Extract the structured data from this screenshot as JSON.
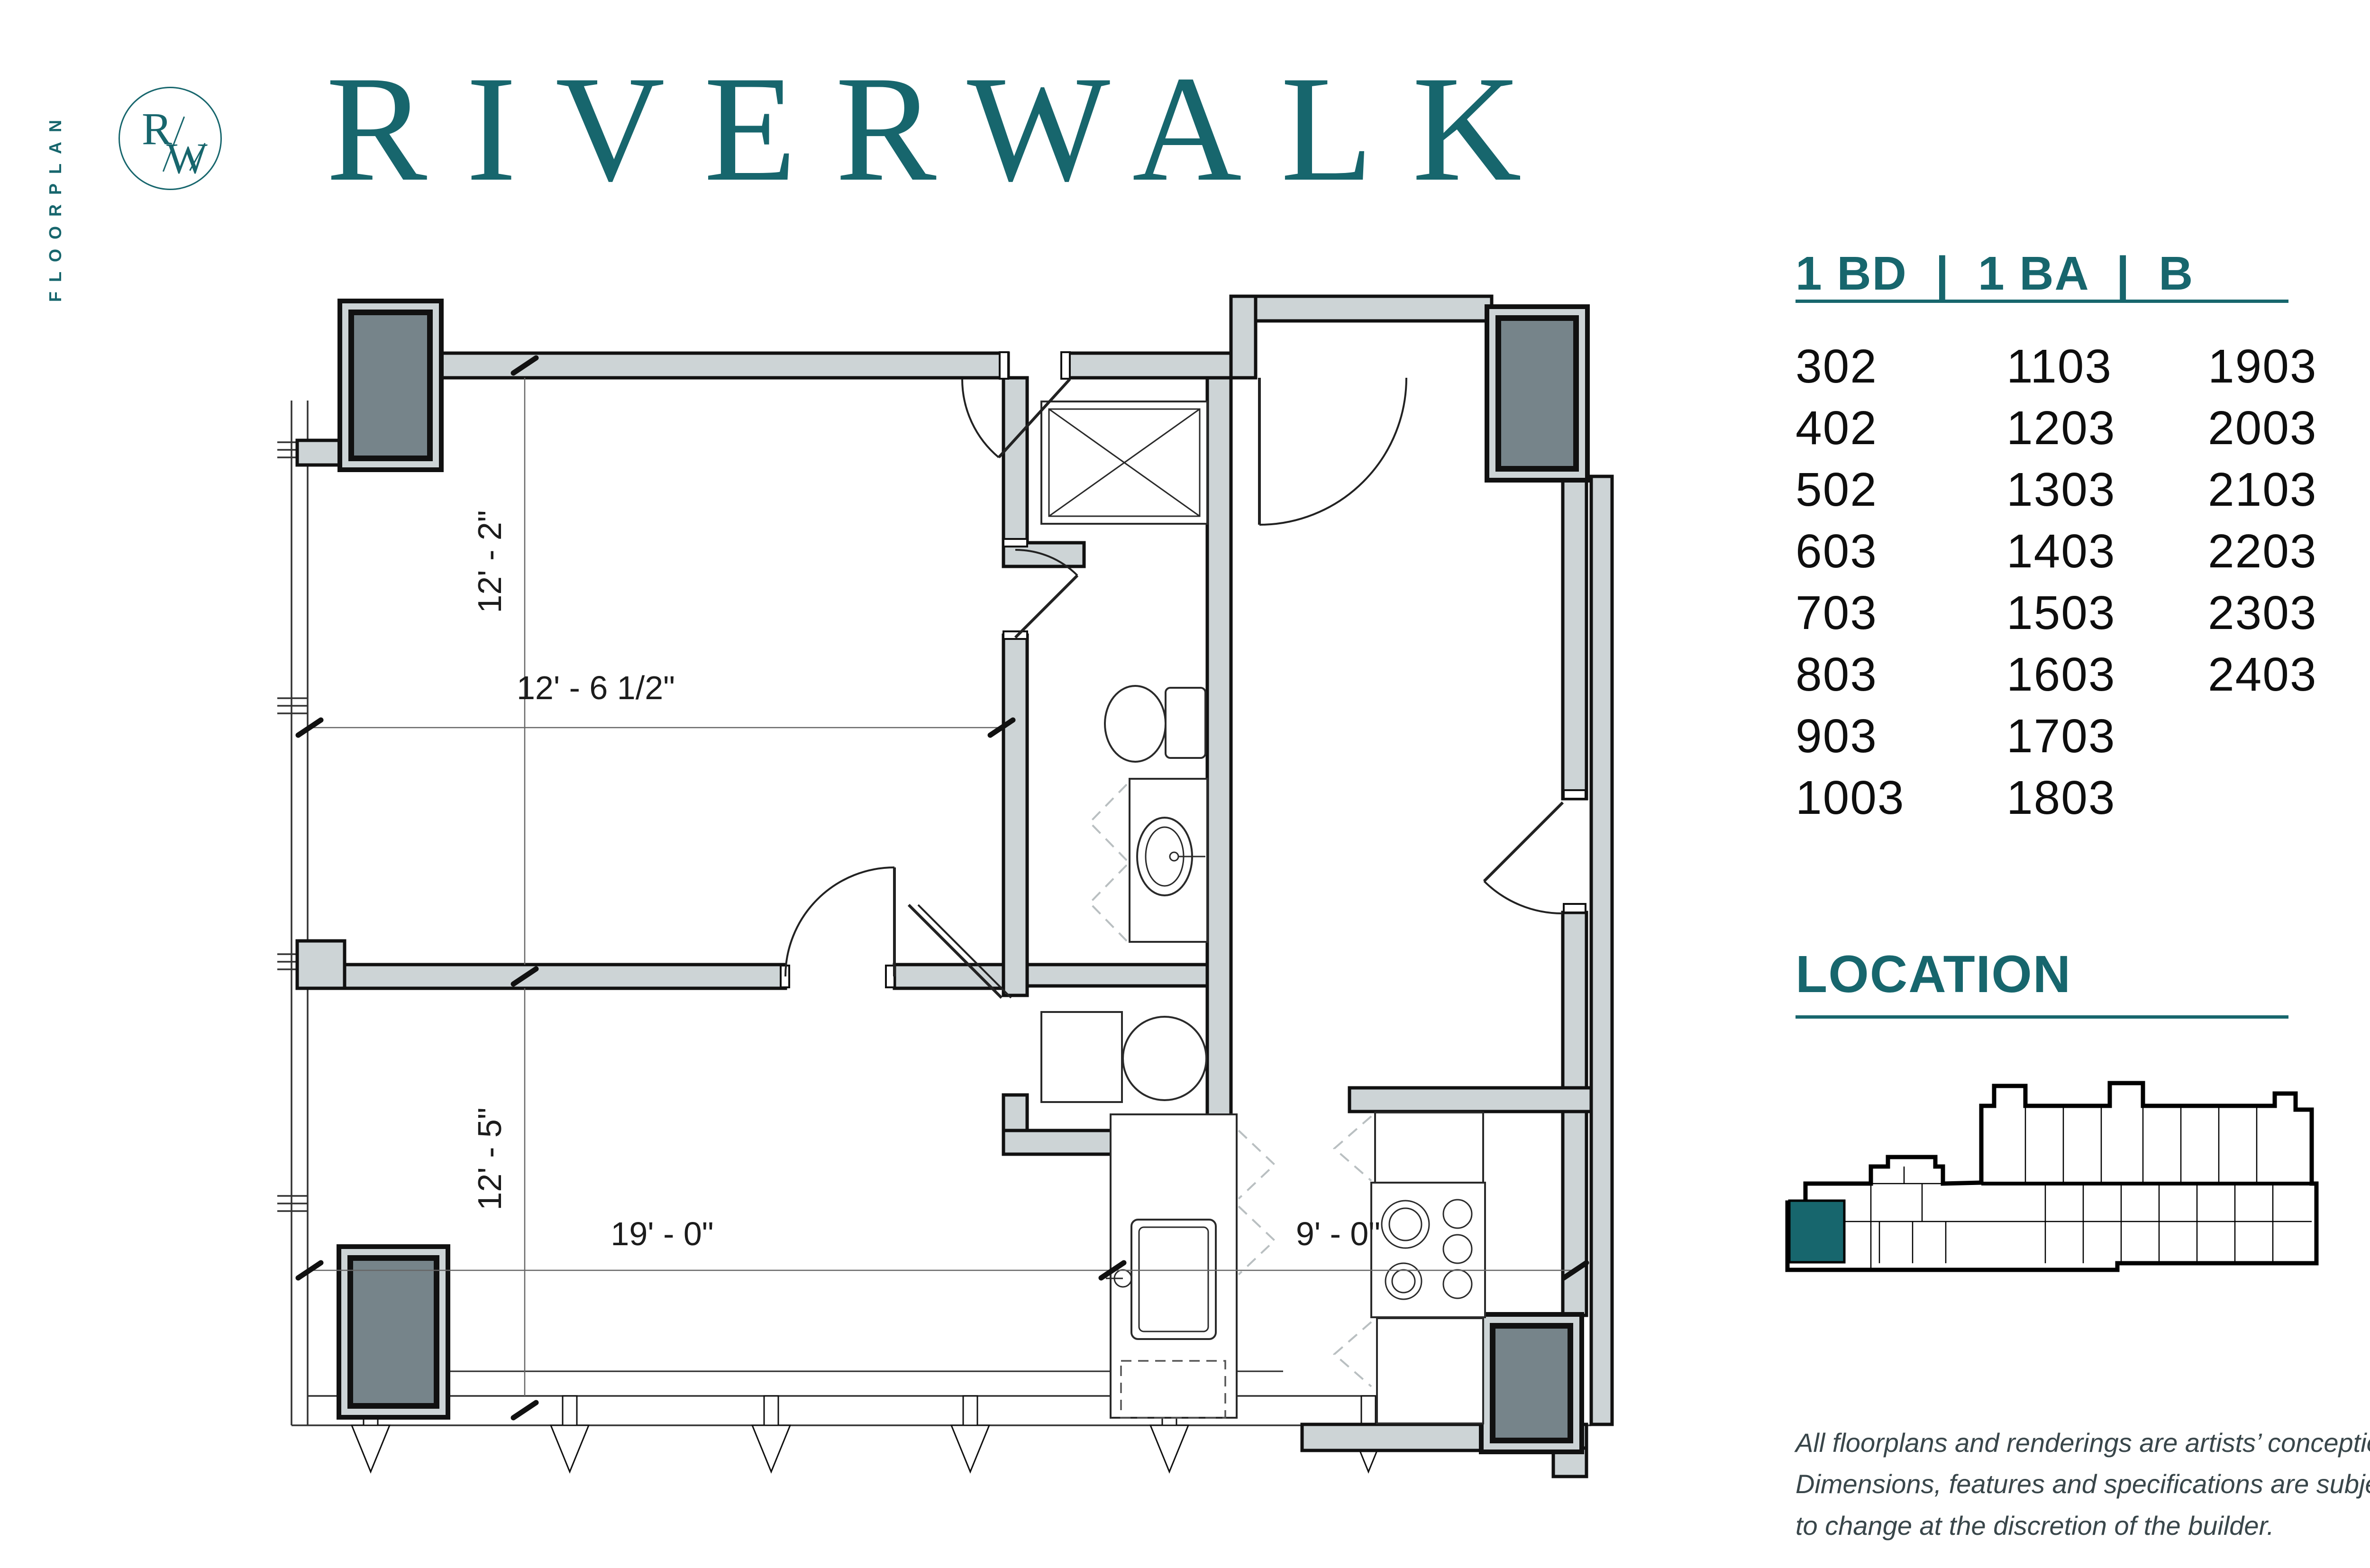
{
  "colors": {
    "teal": "#17666d",
    "wall_fill": "#cdd4d6",
    "shaft_fill": "#76848a",
    "disclaimer_text": "#39464a"
  },
  "sidebar": {
    "vertical_label": "FLOORPLAN"
  },
  "logo": {
    "letter_r": "R",
    "letter_w": "W"
  },
  "header": {
    "title": "RIVERWALK"
  },
  "unit_panel": {
    "header": "1 BD  |  1 BA  |  B",
    "columns": [
      [
        "302",
        "402",
        "502",
        "603",
        "703",
        "803",
        "903",
        "1003"
      ],
      [
        "1103",
        "1203",
        "1303",
        "1403",
        "1503",
        "1603",
        "1703",
        "1803"
      ],
      [
        "1903",
        "2003",
        "2103",
        "2203",
        "2303",
        "2403"
      ]
    ]
  },
  "location_panel": {
    "header": "LOCATION"
  },
  "floorplan": {
    "dim_bedroom_depth": "12' - 2\"",
    "dim_bedroom_width": "12' - 6 1/2\"",
    "dim_living_depth": "12' - 5\"",
    "dim_living_width": "19' - 0\"",
    "dim_kitchen_width": "9' - 0\""
  },
  "disclaimer": {
    "line1": "All floorplans and renderings are artists’ conception.",
    "line2": "Dimensions, features and specifications are subject",
    "line3": "to change at the discretion of the builder."
  }
}
